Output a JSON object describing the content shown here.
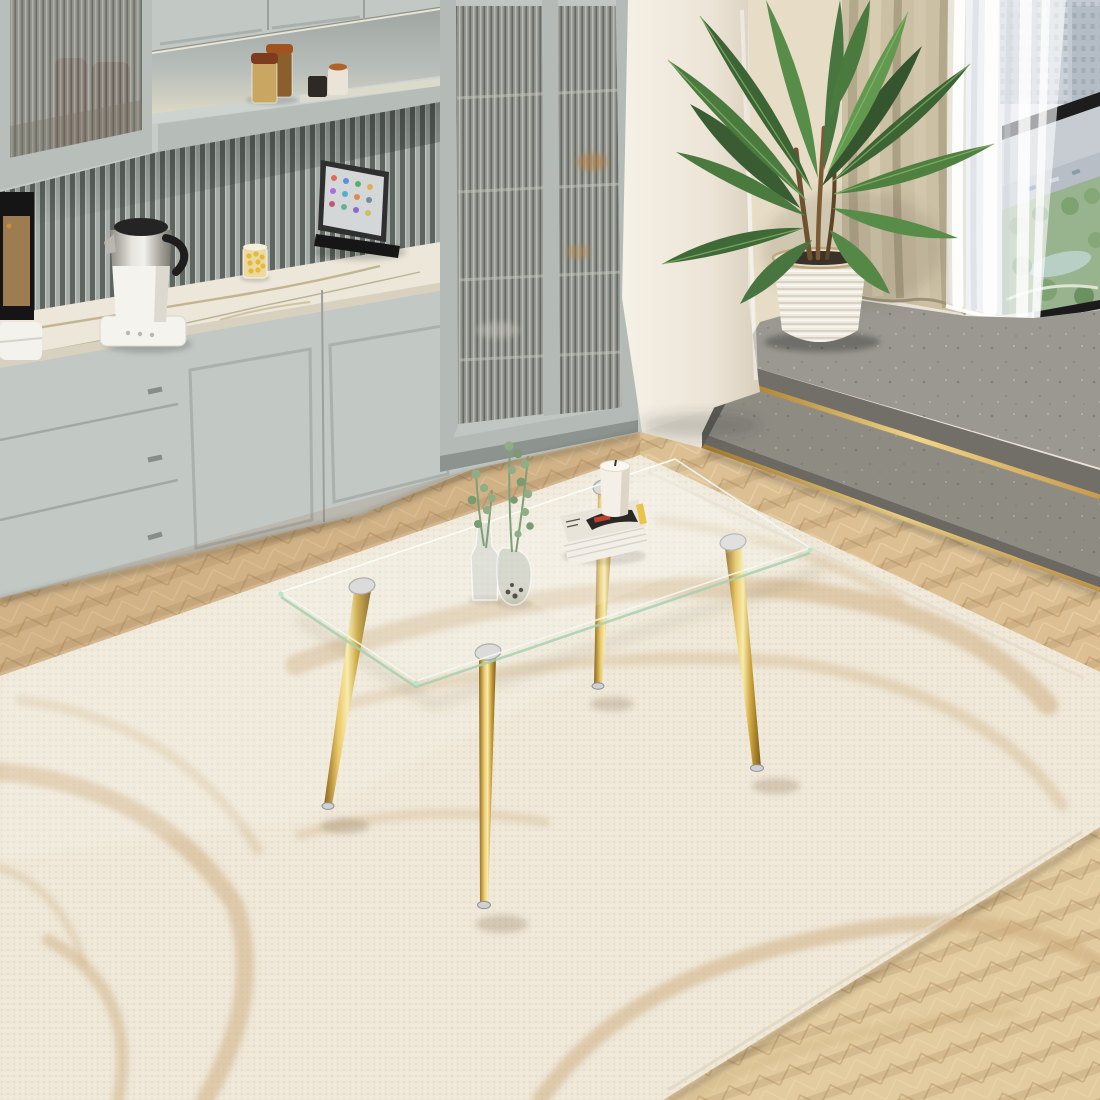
{
  "meta": {
    "scene": "interior product photo",
    "subject": "rectangular clear glass coffee table with four tapered gold metal legs",
    "setting": "bright living room: gray-green cabinetry wall, marble counter, palm plant by window with city view, gray concrete steps with gold trim, cream area rug with tan swirl pattern on herringbone wood floor"
  },
  "palette": {
    "cabinet": "#c6ccc8",
    "cabinet_frame": "#b4bab6",
    "cabinet_shadow": "#99a09b",
    "slat_dark": "#5e6560",
    "slat_light": "#a7ada9",
    "niche_back": "#a9afaa",
    "shelf": "#cbd1cc",
    "marble": "#ece7d9",
    "marble_vein": "#a6935f",
    "wall_column": "#f2ecdf",
    "wall_beige": "#e7dcc6",
    "curtain_beige": "#cbbfa4",
    "curtain_fold": "#b3a78c",
    "sheer_white": "#f7f8fa",
    "window_frame": "#1d1d1d",
    "city_building": "#b3bcc6",
    "city_green": "#98b48e",
    "concrete_top": "#9b9891",
    "concrete_tread": "#8e8b83",
    "concrete_face": "#716f68",
    "gold_trim": "#d8b05e",
    "wood": "#dcc094",
    "wood_grain": "#b89a6c",
    "rug_base": "#efe8d8",
    "rug_swirl": "#cdab7c",
    "glass_edge_green": "#a8d0b0",
    "leg_gold": "#d4a93c",
    "leg_mount_silver": "#d9d9d7",
    "plant_green": "#4b7a3f",
    "plant_green_light": "#63984f",
    "pot_white": "#efeae0",
    "soil": "#3a3128",
    "kettle_white": "#f5f3ee",
    "kettle_steel": "#b5b2a9",
    "kettle_black": "#242424",
    "cork": "#8a4a22",
    "spice_tan": "#c9a763",
    "spice_brown": "#8a5f2b",
    "ipad_screen": "#d3d7d8",
    "stand_black": "#161616",
    "candle_white": "#f4f0e7",
    "magazine_dark": "#2a2824",
    "magazine_red": "#c04030",
    "jar_yellow": "#e3b93c",
    "eucalyptus": "#8fae85"
  },
  "objects": [
    {
      "name": "glass-coffee-table",
      "desc": "clear tempered glass rectangular top with green-tinted edges"
    },
    {
      "name": "gold-table-legs",
      "desc": "four tapered gold chrome legs with silver mounting discs and feet"
    },
    {
      "name": "area-rug",
      "desc": "cream woven rug with tan abstract line swirls"
    },
    {
      "name": "herringbone-wood-floor",
      "desc": "light oak herringbone parquet"
    },
    {
      "name": "kitchen-cabinets",
      "desc": "gray-green shaker cabinets with drawers and lit shelf niche"
    },
    {
      "name": "glass-display-cabinet",
      "desc": "tall fluted-glass door cabinet"
    },
    {
      "name": "slatted-backsplash",
      "desc": "vertical slat wood panel in gray-green"
    },
    {
      "name": "marble-countertop",
      "desc": "white marble with gold veining"
    },
    {
      "name": "electric-kettle",
      "desc": "white and stainless kettle on warming base"
    },
    {
      "name": "tablet-on-stand",
      "desc": "tablet leaning on black stand showing app icons"
    },
    {
      "name": "spice-jars",
      "desc": "cork topped glass jars and small cups on shelf"
    },
    {
      "name": "wall-column",
      "desc": "cream plastered column"
    },
    {
      "name": "concrete-steps",
      "desc": "two gray concrete steps with brass trim strips"
    },
    {
      "name": "potted-palm-plant",
      "desc": "areca palm in white woven planter"
    },
    {
      "name": "beige-curtain",
      "desc": "taupe blackout drape"
    },
    {
      "name": "sheer-curtain",
      "desc": "white voile curtain"
    },
    {
      "name": "window-city-view",
      "desc": "high-rise buildings, road and green park seen from above"
    },
    {
      "name": "eucalyptus-vases",
      "desc": "two small glass vases with eucalyptus sprigs"
    },
    {
      "name": "magazine-stack",
      "desc": "stack of magazines"
    },
    {
      "name": "pillar-candle",
      "desc": "white pillar candle on magazines"
    }
  ]
}
